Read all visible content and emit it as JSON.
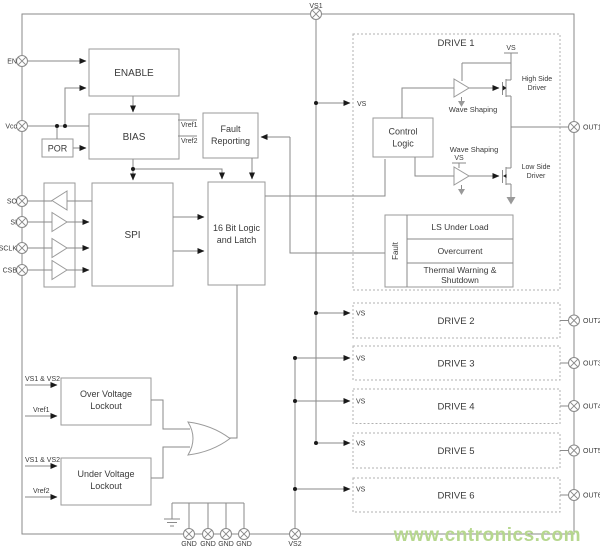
{
  "watermark": "www.cntronics.com",
  "pins": {
    "vs1": "VS1",
    "en": "EN",
    "vcc": "Vcc",
    "so": "SO",
    "si": "SI",
    "sclk": "SCLK",
    "csb": "CSB",
    "gnd1": "GND",
    "gnd2": "GND",
    "gnd3": "GND",
    "gnd4": "GND",
    "vs2": "VS2",
    "out1": "OUT1",
    "out2": "OUT2",
    "out3": "OUT3",
    "out4": "OUT4",
    "out5": "OUT5",
    "out6": "OUT6"
  },
  "blocks": {
    "enable": "ENABLE",
    "bias": "BIAS",
    "por": "POR",
    "spi": "SPI",
    "logic16_l1": "16 Bit Logic",
    "logic16_l2": "and Latch",
    "fault_rep_l1": "Fault",
    "fault_rep_l2": "Reporting",
    "ovl_l1": "Over Voltage",
    "ovl_l2": "Lockout",
    "uvl_l1": "Under Voltage",
    "uvl_l2": "Lockout"
  },
  "signals": {
    "vref1_out": "Vref1",
    "vref2_out": "Vref2",
    "ovl_in1": "VS1 & VS2",
    "ovl_in2": "Vref1",
    "uvl_in1": "VS1 & VS2",
    "uvl_in2": "Vref2"
  },
  "drive1": {
    "title": "DRIVE 1",
    "vs_in": "VS",
    "control_l1": "Control",
    "control_l2": "Logic",
    "vs_rail_high": "VS",
    "vs_rail_low": "VS",
    "wave_shaping_high": "Wave Shaping",
    "wave_shaping_low": "Wave Shaping",
    "high_driver_l1": "High Side",
    "high_driver_l2": "Driver",
    "low_driver_l1": "Low Side",
    "low_driver_l2": "Driver",
    "fault_label": "Fault",
    "fault_row1": "LS Under Load",
    "fault_row2": "Overcurrent",
    "fault_row3_l1": "Thermal Warning &",
    "fault_row3_l2": "Shutdown"
  },
  "drives": [
    {
      "title": "DRIVE 2",
      "vs": "VS"
    },
    {
      "title": "DRIVE 3",
      "vs": "VS"
    },
    {
      "title": "DRIVE 4",
      "vs": "VS"
    },
    {
      "title": "DRIVE 5",
      "vs": "VS"
    },
    {
      "title": "DRIVE 6",
      "vs": "VS"
    }
  ]
}
